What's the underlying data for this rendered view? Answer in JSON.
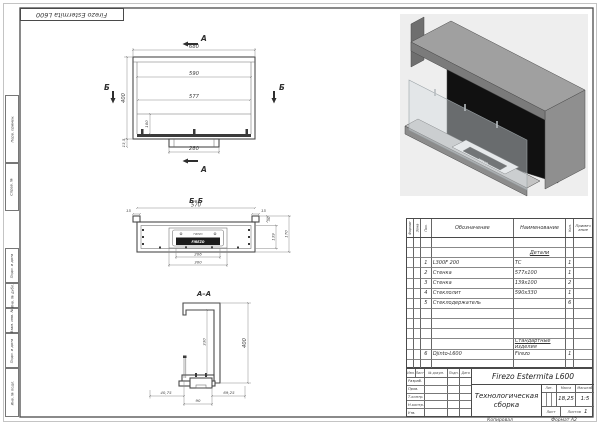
{
  "sheet": {
    "corner_stamp": "Firezo Estermita L600",
    "margin_labels": [
      "Перв. примен.",
      "Справ. №",
      "Подп. и дата",
      "Инв. № дубл.",
      "Взам. инв. №",
      "Подп. и дата",
      "Инв. № подл."
    ],
    "copied": "Копировал",
    "format": "Формат А2"
  },
  "drawing": {
    "brand": "FIREZO",
    "front": {
      "mark_a": "А",
      "mark_b": "Б",
      "dim_overall_width": "680",
      "dim_inner_width": "590",
      "dim_glass_width": "577",
      "dim_height": "400",
      "dim_burner_zone": "100",
      "dim_base_width": "280",
      "dim_base_height": "13,5"
    },
    "section_bb": {
      "title": "Б–Б",
      "dim_width": "570",
      "dim_flange_left": "15",
      "dim_flange_right": "15",
      "dim_top": "30",
      "dim_inner_depth": "139",
      "dim_depth": "170",
      "dim_burner": "206",
      "dim_tray": "300"
    },
    "section_aa": {
      "title": "А–А",
      "dim_height": "400",
      "dim_opening": "330",
      "dim_front": "40,75",
      "dim_burner": "90",
      "dim_back": "69,25"
    }
  },
  "parts": {
    "headers": [
      "Формат",
      "Зона",
      "Поз.",
      "Обозначение",
      "Наименование",
      "Кол.",
      "Примечание"
    ],
    "group_details": "Детали",
    "group_standard": "Стандартные изделия",
    "rows": [
      {
        "pos": "1",
        "designation": "L300F 200",
        "name": "ТС",
        "qty": "1"
      },
      {
        "pos": "2",
        "designation": "Стенка",
        "name": "577x100",
        "qty": "1"
      },
      {
        "pos": "3",
        "designation": "Стенка",
        "name": "139x100",
        "qty": "2"
      },
      {
        "pos": "4",
        "designation": "Стеклолит",
        "name": "590x330",
        "qty": "1"
      },
      {
        "pos": "5",
        "designation": "Стеклодержатель",
        "name": "",
        "qty": "6"
      },
      {
        "pos": "6",
        "designation": "Djinto-L600",
        "name": "Firezo",
        "qty": "1"
      }
    ]
  },
  "titleblock": {
    "title": "Firezo Estermita L600",
    "doc_type": "Технологическая сборка",
    "col_lit": "Лит.",
    "col_mass": "Масса",
    "col_scale": "Масштаб",
    "mass": "18,25",
    "scale": "1:5",
    "sheet_label": "Лист",
    "sheets_label": "Листов",
    "sheets_value": "1",
    "header_row": [
      "Изм.",
      "Лист",
      "№ докум.",
      "Подп.",
      "Дата"
    ],
    "sign_rows": [
      "Разраб.",
      "Пров.",
      "Т.контр.",
      "Н.контр.",
      "Утв."
    ]
  }
}
